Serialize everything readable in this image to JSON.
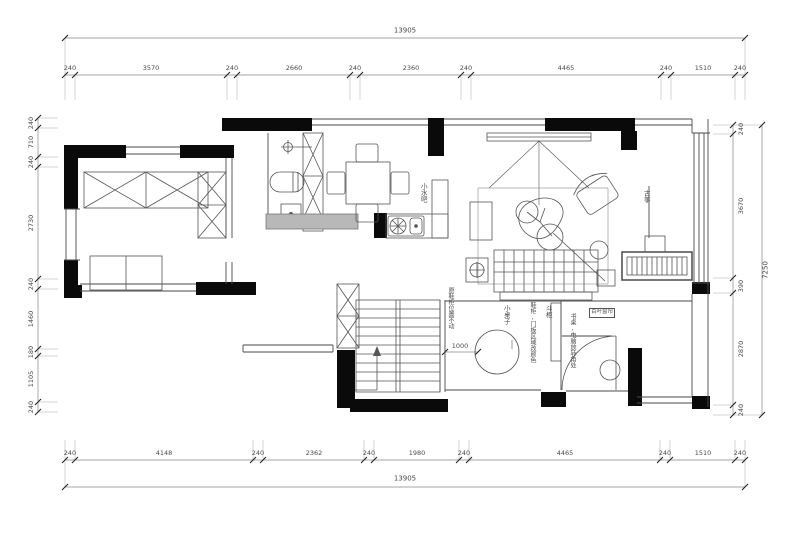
{
  "drawing": {
    "title": "residential floor plan",
    "dimensions": {
      "top_total": "13905",
      "bottom_total": "13905",
      "right_total": "7250",
      "stair_width": "1000",
      "top": [
        "240",
        "3570",
        "240",
        "2660",
        "240",
        "2360",
        "240",
        "4465",
        "240",
        "1510",
        "240"
      ],
      "bottom": [
        "240",
        "4148",
        "240",
        "2362",
        "240",
        "1980",
        "240",
        "4465",
        "240",
        "1510",
        "240"
      ],
      "left": [
        "240",
        "710",
        "240",
        "2730",
        "240",
        "1460",
        "180",
        "1105",
        "240"
      ],
      "right": [
        "240",
        "3670",
        "390",
        "2870",
        "240"
      ]
    },
    "annotations": {
      "water_bar": "小水吧",
      "guzheng": "古筝",
      "small_table": "小桌子",
      "stairs_note": "原鞋柜位置不动",
      "cabinet_note": "鞋柜,门板区域改颜色",
      "chest": "斗柜",
      "desk_note": "书桌,电脑放转角处",
      "blinds": "百叶窗帘"
    },
    "colors": {
      "wall": "#0a0a0a",
      "line": "#4a4a4a",
      "dim_line": "#888888",
      "tick": "#222222",
      "counter_fill": "#b8b8b8"
    }
  }
}
